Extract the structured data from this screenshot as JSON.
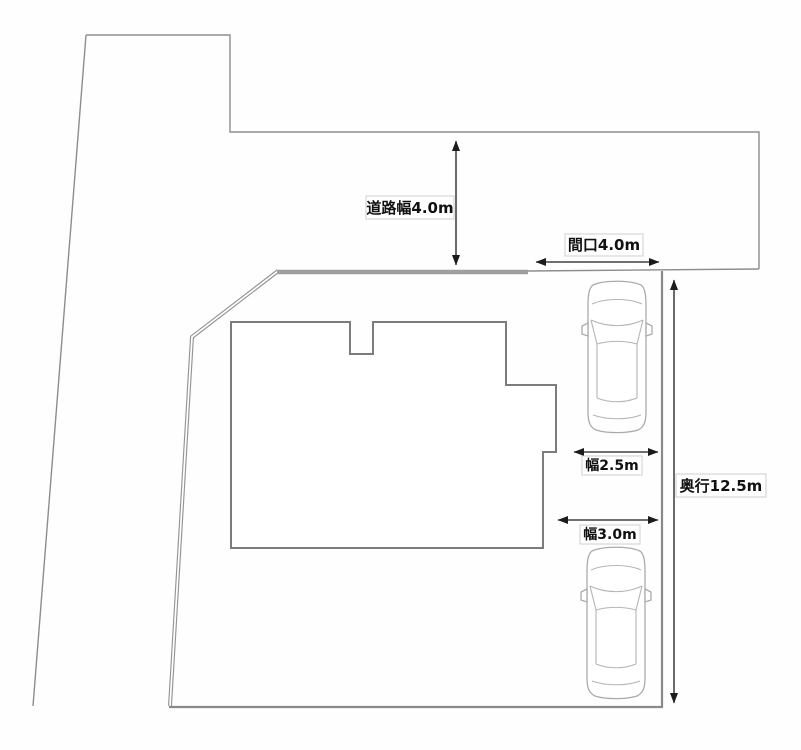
{
  "diagram": {
    "kind": "property-site-plan",
    "labels": {
      "road_width": "道路幅4.0m",
      "frontage": "間口4.0m",
      "parking_width_upper": "幅2.5m",
      "depth": "奥行12.5m",
      "parking_width_lower": "幅3.0m"
    },
    "objects": {
      "car_count": 2,
      "building_count": 1
    },
    "colors": {
      "background": "#fefefe",
      "boundary_line": "#8d8d8d",
      "thick_road_edge": "#9f9f9f",
      "lot_boundary": "#8a8a8a",
      "building_outline": "#7c7c7c",
      "dimension_line": "#1b1b1b",
      "label_border": "#cfcfcf",
      "label_text": "#111111",
      "car_outline": "#ababab"
    }
  }
}
